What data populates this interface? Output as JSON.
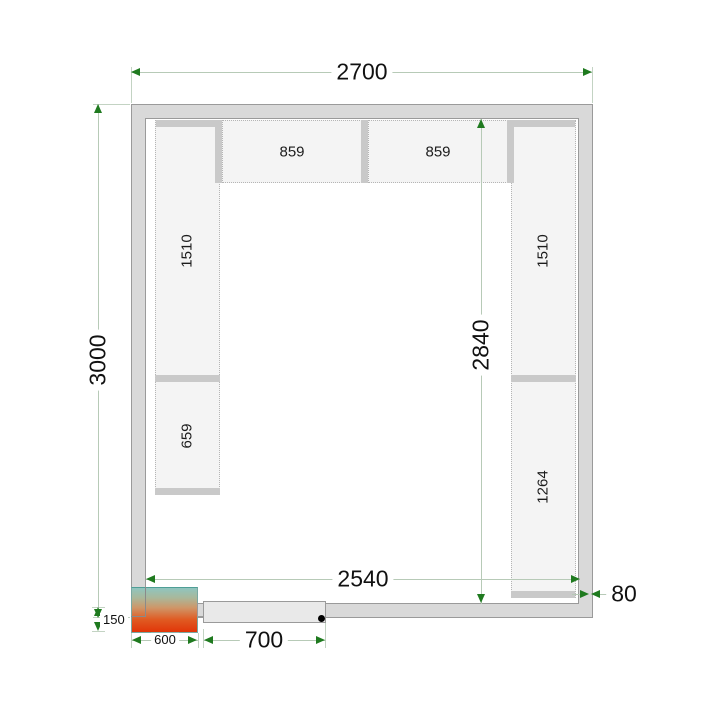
{
  "labels": {
    "outer_width": "2700",
    "outer_depth": "3000",
    "inner_width": "2540",
    "inner_depth": "2840",
    "wall_thickness": "80",
    "door_width": "700",
    "unit_width": "600",
    "unit_protrusion": "150",
    "shelf_top_left": "859",
    "shelf_top_right": "859",
    "shelf_left_upper": "1510",
    "shelf_left_lower": "659",
    "shelf_right_upper": "1510",
    "shelf_right_lower": "1264"
  },
  "colors": {
    "wall_fill": "#d9d9d9",
    "wall_line": "#9a9a9a",
    "shelf_fill": "#f4f4f4",
    "shelf_border": "#b5b5b5",
    "support_bar": "#c9c9c9",
    "dim_line": "#b7cab7",
    "dim_arrow": "#1f7a1f",
    "unit_top": "#8fc5bf",
    "unit_bottom": "#e13508",
    "door_fill": "#e9e9e9",
    "hinge_dot": "#000000"
  }
}
